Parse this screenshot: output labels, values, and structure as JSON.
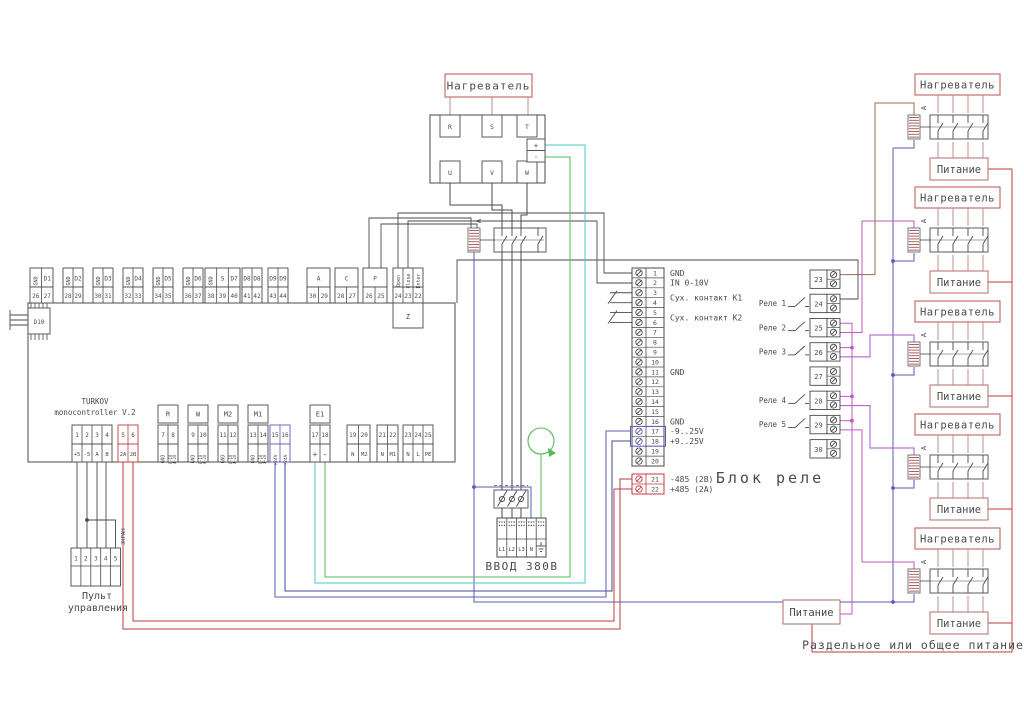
{
  "controller": {
    "title1": "TURKOV",
    "title2": "monocontroller V.2",
    "d10": "D10",
    "z_label": "Z",
    "top_blocks": [
      {
        "headers": [
          "GND",
          "D1"
        ],
        "vert": [
          true,
          false
        ],
        "numbers": [
          "26",
          "27"
        ]
      },
      {
        "headers": [
          "GND",
          "D2"
        ],
        "vert": [
          true,
          false
        ],
        "numbers": [
          "28",
          "29"
        ]
      },
      {
        "headers": [
          "GND",
          "D3"
        ],
        "vert": [
          true,
          false
        ],
        "numbers": [
          "30",
          "31"
        ]
      },
      {
        "headers": [
          "GND",
          "D4"
        ],
        "vert": [
          true,
          false
        ],
        "numbers": [
          "32",
          "33"
        ]
      },
      {
        "headers": [
          "GND",
          "D5"
        ],
        "vert": [
          true,
          false
        ],
        "numbers": [
          "34",
          "35"
        ]
      },
      {
        "headers": [
          "GND",
          "D6"
        ],
        "vert": [
          true,
          false
        ],
        "numbers": [
          "36",
          "37"
        ]
      },
      {
        "headers": [
          "GND",
          "S",
          "D7"
        ],
        "vert": [
          true,
          false,
          false
        ],
        "numbers": [
          "38",
          "39",
          "40"
        ]
      },
      {
        "headers": [
          "D8",
          "D8"
        ],
        "vert": [
          false,
          false
        ],
        "numbers": [
          "41",
          "42"
        ]
      },
      {
        "headers": [
          "D9",
          "D9"
        ],
        "vert": [
          false,
          false
        ],
        "numbers": [
          "43",
          "44"
        ]
      },
      {
        "headers": [
          "A"
        ],
        "vert": [
          false
        ],
        "numbers": [
          "30",
          "29"
        ]
      },
      {
        "headers": [
          "C"
        ],
        "vert": [
          false
        ],
        "numbers": [
          "28",
          "27"
        ]
      },
      {
        "headers": [
          "P"
        ],
        "vert": [
          false
        ],
        "numbers": [
          "26",
          "25"
        ]
      },
      {
        "headers": [
          "Open",
          "Close",
          "Enter"
        ],
        "vert": [
          true,
          true,
          true
        ],
        "numbers": [
          "24",
          "23",
          "22"
        ],
        "sub": "Z"
      }
    ],
    "bottom_blocks": [
      {
        "numbers": [
          "1",
          "2",
          "3",
          "4"
        ],
        "labels": [
          "+5",
          "-5",
          "A",
          "B"
        ],
        "style": "dark"
      },
      {
        "numbers": [
          "5",
          "6"
        ],
        "labels": [
          "2A",
          "2B"
        ],
        "style": "red"
      },
      {
        "header": "R",
        "numbers": [
          "7",
          "8"
        ],
        "labels": [
          "GND",
          "0-10",
          "4-20"
        ],
        "style": "gndout"
      },
      {
        "header": "W",
        "numbers": [
          "9",
          "10"
        ],
        "labels": [
          "GND",
          "0-10",
          "4-20"
        ],
        "style": "gndout"
      },
      {
        "header": "M2",
        "numbers": [
          "11",
          "12"
        ],
        "labels": [
          "GND",
          "0-10",
          "4-20"
        ],
        "style": "gndout"
      },
      {
        "header": "M1",
        "numbers": [
          "13",
          "14"
        ],
        "labels": [
          "GND",
          "0-10",
          "4-20"
        ],
        "style": "gndout"
      },
      {
        "numbers": [
          "15",
          "16"
        ],
        "labels": [
          "+24V",
          "-24V"
        ],
        "style": "blue"
      },
      {
        "header": "E1",
        "numbers": [
          "17",
          "18"
        ],
        "labels": [
          "+",
          "-"
        ],
        "style": "pm"
      },
      {
        "numbers": [
          "19",
          "20"
        ],
        "labels": [
          "N",
          "M2"
        ],
        "style": "dark"
      },
      {
        "numbers": [
          "21",
          "22"
        ],
        "labels": [
          "N",
          "M1"
        ],
        "style": "dark"
      },
      {
        "numbers": [
          "23",
          "24",
          "25"
        ],
        "labels": [
          "N",
          "L",
          "PE"
        ],
        "style": "dark"
      }
    ]
  },
  "panel": {
    "label1": "Пульт",
    "label2": "управления",
    "shield": "ЭКРАН",
    "numbers": [
      "1",
      "2",
      "3",
      "4",
      "5"
    ]
  },
  "heater_main": {
    "label": "Нагреватель",
    "contactor": "А",
    "top": [
      "R",
      "S",
      "T"
    ],
    "bottom": [
      "U",
      "V",
      "W"
    ],
    "plus": "+",
    "minus": "-"
  },
  "vvod": {
    "label": "ВВОД 380В",
    "cells": [
      "L1",
      "L2",
      "L3",
      "N"
    ]
  },
  "strip": {
    "k1": "Сух. контакт К1",
    "k2": "Сух. контакт К2",
    "rows": [
      {
        "n": "1",
        "label": "GND"
      },
      {
        "n": "2",
        "label": "IN 0-10V"
      },
      {
        "n": "3"
      },
      {
        "n": "4"
      },
      {
        "n": "5"
      },
      {
        "n": "6"
      },
      {
        "n": "7"
      },
      {
        "n": "8"
      },
      {
        "n": "9"
      },
      {
        "n": "10"
      },
      {
        "n": "11",
        "label": "GND"
      },
      {
        "n": "12"
      },
      {
        "n": "13"
      },
      {
        "n": "14"
      },
      {
        "n": "15"
      },
      {
        "n": "16",
        "label": "GND"
      },
      {
        "n": "17",
        "label": "-9..25V",
        "color": "blue"
      },
      {
        "n": "18",
        "label": "+9..25V",
        "color": "blue"
      },
      {
        "n": "19"
      },
      {
        "n": "20"
      }
    ],
    "rows485": [
      {
        "n": "21",
        "label": "-485 (2B)"
      },
      {
        "n": "22",
        "label": "+485 (2A)"
      }
    ]
  },
  "relay": {
    "title": "Блок реле",
    "groups": [
      "23",
      "24",
      "25",
      "26",
      "27",
      "28",
      "29",
      "30"
    ],
    "relays": [
      {
        "label": "Реле 1",
        "group": 1
      },
      {
        "label": "Реле 2",
        "group": 2
      },
      {
        "label": "Реле 3",
        "group": 3
      },
      {
        "label": "Реле 4",
        "group": 5
      },
      {
        "label": "Реле 5",
        "group": 6
      }
    ]
  },
  "units": {
    "heater": "Нагреватель",
    "power": "Питание",
    "contactor": "А",
    "count": 5
  },
  "bottom": {
    "power": "Питание",
    "caption": "Раздельное или общее питание"
  },
  "colors": {
    "line": "#4a4a4a",
    "softRed": "#c06060",
    "red": "#c23b3b",
    "blue": "#5b5bb5",
    "cyan": "#4cc8c8",
    "green": "#58b858",
    "magenta": "#c25ac2",
    "violet": "#a855c8",
    "brown": "#9a6a50",
    "powerText": "#7a4a4a",
    "powerBox": "#b36b6b",
    "pink": "#bb8f8f",
    "coil": "#a05050"
  }
}
